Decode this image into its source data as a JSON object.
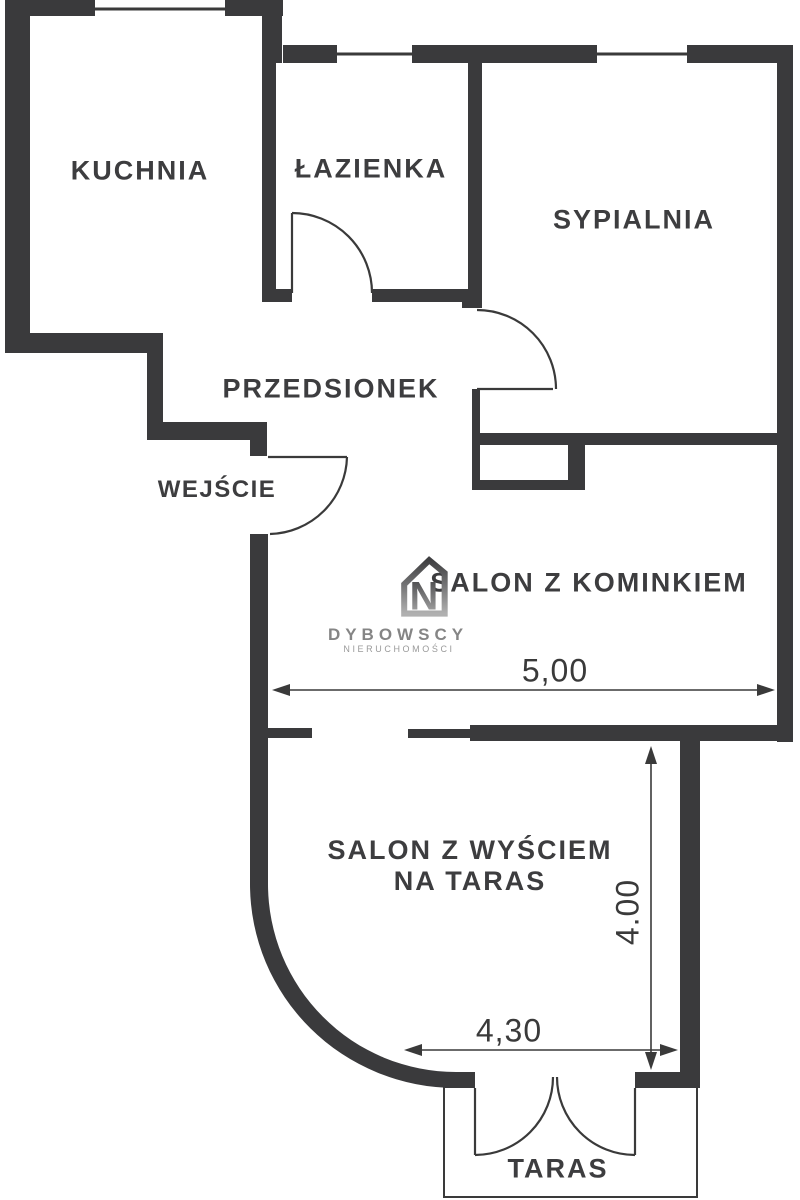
{
  "rooms": {
    "kuchnia": "KUCHNIA",
    "lazienka": "ŁAZIENKA",
    "sypialnia": "SYPIALNIA",
    "przedsionek": "PRZEDSIONEK",
    "wejscie": "WEJŚCIE",
    "salon_kominek": "SALON Z KOMINKIEM",
    "salon_taras_line1": "SALON Z WYŚCIEM",
    "salon_taras_line2": "NA TARAS",
    "taras": "TARAS"
  },
  "dimensions": {
    "salon_width": "5,00",
    "salon_height": "4.00",
    "taras_width": "4,30"
  },
  "logo": {
    "monogram": "N",
    "name": "DYBOWSCY",
    "subtitle": "NIERUCHOMOŚCI"
  },
  "colors": {
    "wall": "#3a3a3c",
    "line": "#3a3a3a",
    "text": "#3d3d3f",
    "logo_text": "#858585",
    "logo_subtext": "#9a9a9a",
    "background": "#ffffff"
  }
}
